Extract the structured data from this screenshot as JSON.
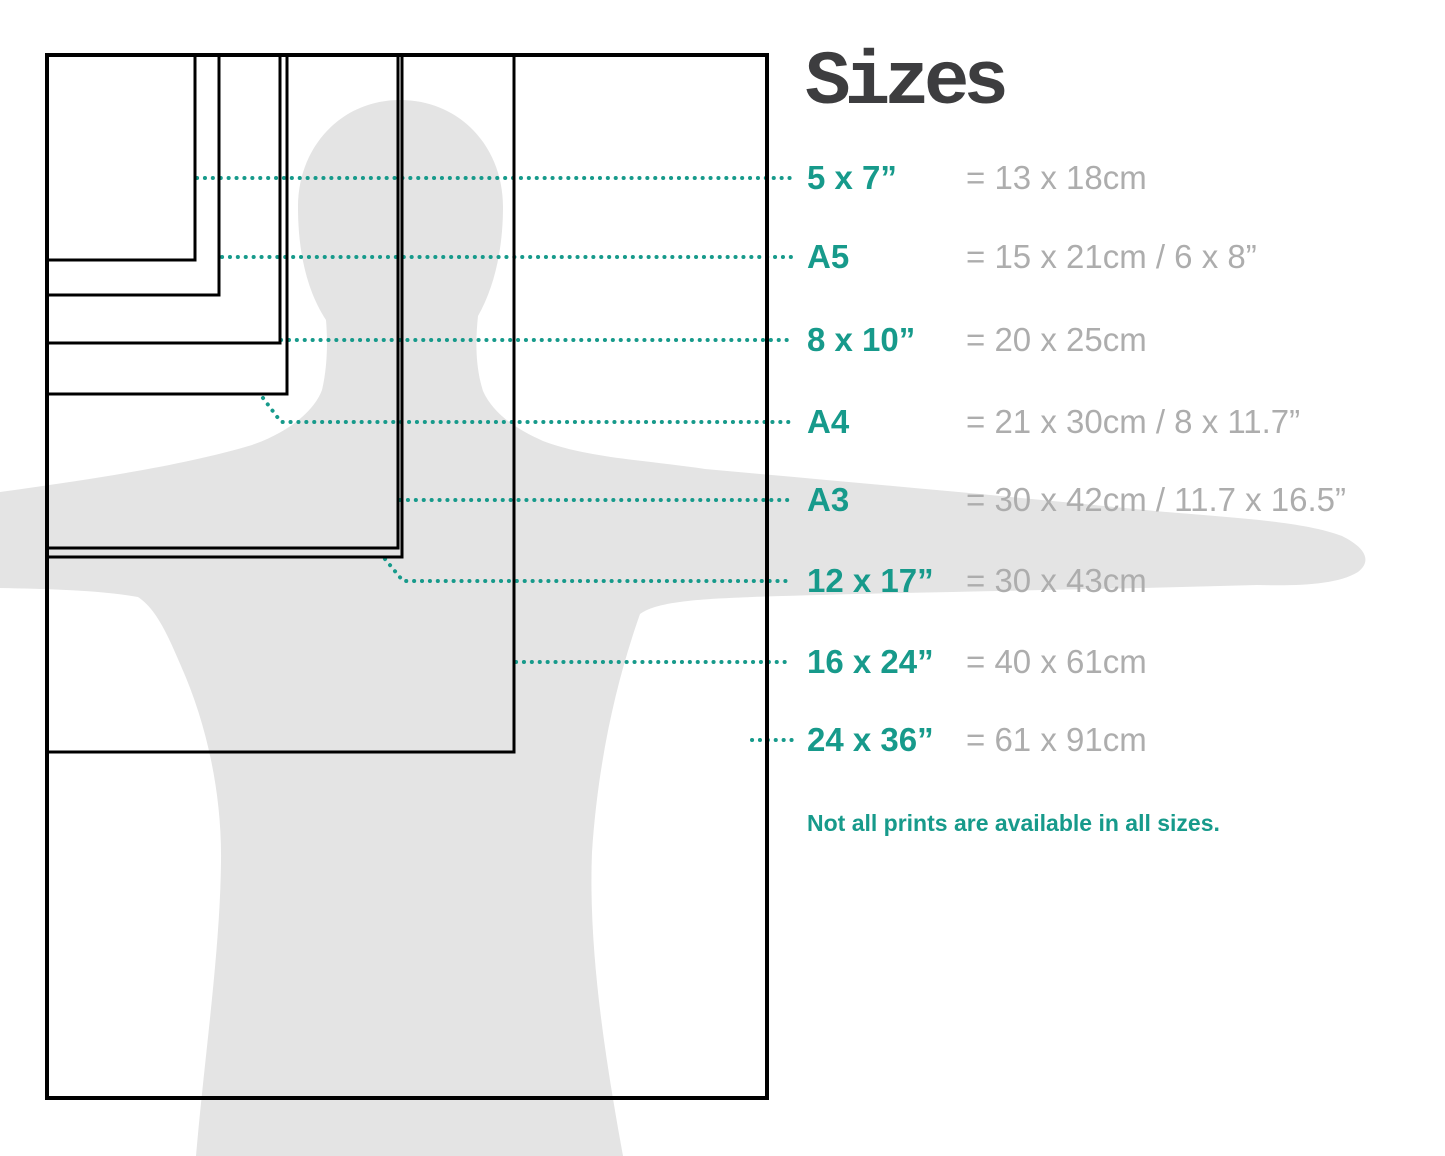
{
  "title": "Sizes",
  "note": "Not all prints are available in all sizes.",
  "colors": {
    "accent": "#179a8b",
    "muted_text": "#adadad",
    "title_text": "#3d3d3f",
    "silhouette": "#e4e4e4",
    "outline": "#000000"
  },
  "diagram": {
    "origin": {
      "x": 47,
      "y": 55
    },
    "outer_stroke": 4,
    "inner_stroke": 3,
    "leader_end_x": 792
  },
  "sizes": [
    {
      "label": "5 x 7”",
      "metric": "= 13 x 18cm",
      "rect": {
        "w": 148,
        "h": 205
      },
      "row_y": 178,
      "leader": [
        [
          197,
          178
        ],
        [
          792,
          178
        ]
      ]
    },
    {
      "label": "A5",
      "metric": "= 15 x 21cm / 6 x 8”",
      "rect": {
        "w": 172,
        "h": 240
      },
      "row_y": 257,
      "leader": [
        [
          222,
          257
        ],
        [
          792,
          257
        ]
      ]
    },
    {
      "label": "8 x 10”",
      "metric": "= 20 x 25cm",
      "rect": {
        "w": 233,
        "h": 288
      },
      "row_y": 340,
      "leader": [
        [
          281,
          340
        ],
        [
          792,
          340
        ]
      ]
    },
    {
      "label": "A4",
      "metric": "= 21 x 30cm / 8 x 11.7”",
      "rect": {
        "w": 240,
        "h": 339
      },
      "row_y": 422,
      "leader": [
        [
          263,
          398
        ],
        [
          281,
          422
        ],
        [
          792,
          422
        ]
      ]
    },
    {
      "label": "A3",
      "metric": "= 30 x 42cm / 11.7 x 16.5”",
      "rect": {
        "w": 351,
        "h": 493
      },
      "row_y": 500,
      "leader": [
        [
          400,
          500
        ],
        [
          792,
          500
        ]
      ]
    },
    {
      "label": "12 x 17”",
      "metric": "= 30 x 43cm",
      "rect": {
        "w": 355,
        "h": 502
      },
      "row_y": 581,
      "leader": [
        [
          385,
          559
        ],
        [
          403,
          581
        ],
        [
          792,
          581
        ]
      ]
    },
    {
      "label": "16 x 24”",
      "metric": "= 40 x 61cm",
      "rect": {
        "w": 467,
        "h": 697
      },
      "row_y": 662,
      "leader": [
        [
          516,
          662
        ],
        [
          792,
          662
        ]
      ]
    },
    {
      "label": "24 x 36”",
      "metric": "= 61 x 91cm",
      "rect": {
        "w": 720,
        "h": 1043
      },
      "row_y": 740,
      "leader": [
        [
          752,
          740
        ],
        [
          792,
          740
        ]
      ]
    }
  ]
}
